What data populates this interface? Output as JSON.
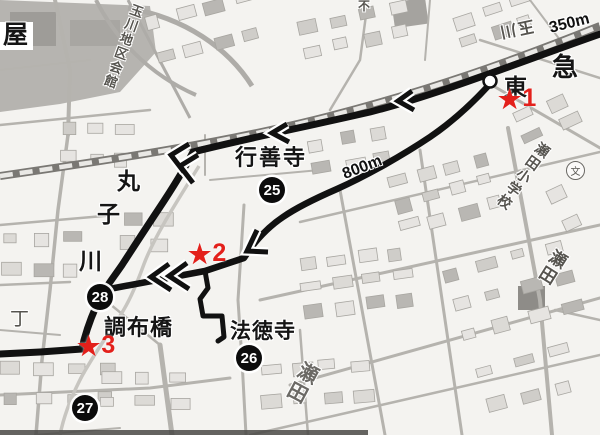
{
  "map": {
    "region_labels": {
      "yane": "屋",
      "tamagawa_hall": "玉川地区会館",
      "gyozenji": "行善寺",
      "marukogawa": [
        "丸",
        "子",
        "川"
      ],
      "tokyu": [
        "東",
        "急"
      ],
      "chofubashi": "調布橋",
      "hotokuji": "法徳寺",
      "seta_elementary": "瀬田小学校",
      "seta_right": "瀬田",
      "seta_bottom": "瀬田",
      "chome": "丁",
      "fu": "不",
      "station_label_rotated": "玉川",
      "school_symbol": "文"
    },
    "route": {
      "distances": [
        {
          "label": "350m"
        },
        {
          "label": "800m"
        }
      ],
      "stops": [
        {
          "number": "25",
          "name": "行善寺"
        },
        {
          "number": "26",
          "name": "法徳寺"
        },
        {
          "number": "27",
          "name": ""
        },
        {
          "number": "28",
          "name": ""
        }
      ],
      "stars": [
        {
          "symbol": "★",
          "number": "1"
        },
        {
          "symbol": "★",
          "number": "2"
        },
        {
          "symbol": "★",
          "number": "3"
        }
      ]
    },
    "colors": {
      "route": "#111111",
      "marker_red": "#e3201b",
      "railway": "#7a7874",
      "street": "#b5b3ae",
      "stop_circle": "#0c0c0c"
    }
  }
}
